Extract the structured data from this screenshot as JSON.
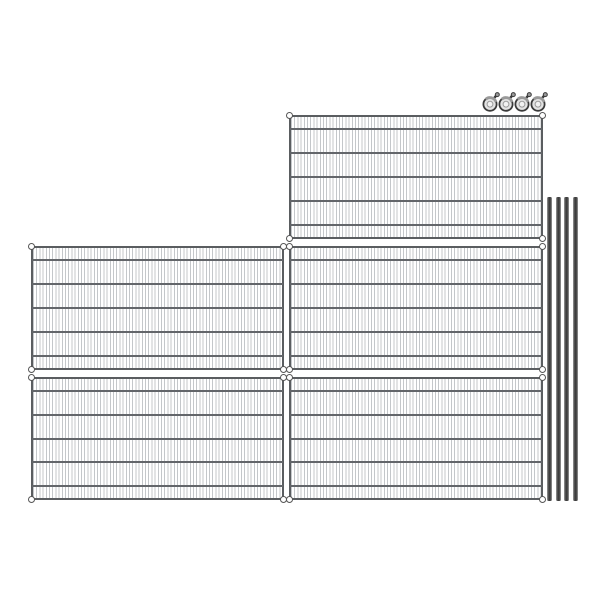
{
  "image": {
    "kind": "product-illustration",
    "subject": "wire-shelving-kit",
    "background": "#ffffff",
    "width": 600,
    "height": 600
  },
  "colors": {
    "wire_fine": "#c4c7ca",
    "wire_heavy": "#63666a",
    "frame": "#5a5d60",
    "collar_fill": "#ffffff",
    "collar_ring": "#565656",
    "pole_dark": "#3d3d3d",
    "pole_mid": "#5c5c5c",
    "pole_light": "#a3a3a3",
    "caster_dark": "#3a3a3a",
    "caster_mid": "#9a9a9a",
    "caster_fill": "#e3e3e3",
    "caster_hub": "#f2f2f2"
  },
  "counts": {
    "shelves": 5,
    "poles": 4,
    "casters": 4
  },
  "parts": {
    "shelves": [
      {
        "name": "shelf-panel-top",
        "x": 289,
        "y": 115,
        "w": 254,
        "h": 124
      },
      {
        "name": "shelf-panel-middle-left",
        "x": 31,
        "y": 246,
        "w": 253,
        "h": 124
      },
      {
        "name": "shelf-panel-middle-right",
        "x": 289,
        "y": 246,
        "w": 254,
        "h": 124
      },
      {
        "name": "shelf-panel-bottom-left",
        "x": 31,
        "y": 377,
        "w": 253,
        "h": 123
      },
      {
        "name": "shelf-panel-bottom-right",
        "x": 289,
        "y": 377,
        "w": 254,
        "h": 123
      }
    ],
    "shelf_style": {
      "cross_wire_pct": [
        10,
        30,
        50,
        70,
        90
      ],
      "fine_wire_pitch_px": 3.2,
      "corner_collars": [
        "tl",
        "tr",
        "bl",
        "br"
      ]
    },
    "poles": {
      "x_positions": [
        547,
        555.6,
        564.2,
        572.8
      ],
      "y": 197,
      "height": 304,
      "width": 5
    },
    "casters": {
      "x_positions": [
        482,
        498,
        514,
        530
      ],
      "y": 91,
      "width": 18,
      "height": 21
    }
  }
}
